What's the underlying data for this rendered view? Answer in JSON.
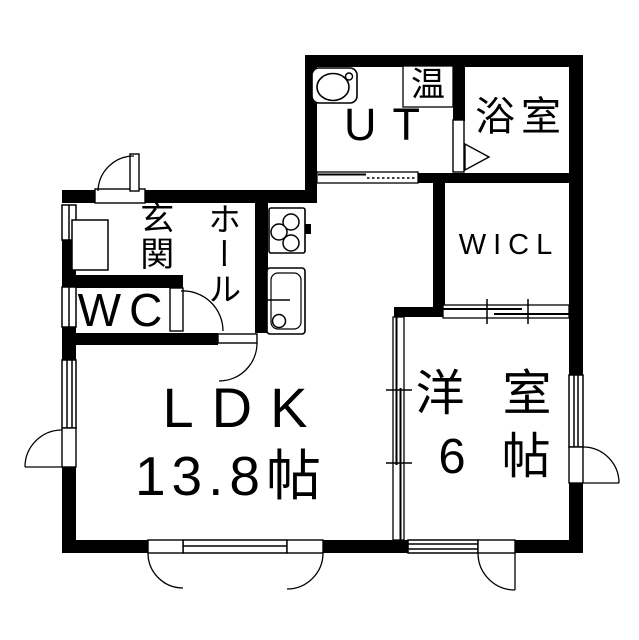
{
  "meta": {
    "type": "floor-plan",
    "background_color": "#ffffff",
    "wall_color": "#000000"
  },
  "rooms": {
    "bath": {
      "label": "浴室"
    },
    "ut": {
      "label": "UT"
    },
    "water_heater": {
      "label": "温"
    },
    "wicl": {
      "label": "WICL"
    },
    "genkan": {
      "label": "玄関"
    },
    "hall": {
      "label": "ホール"
    },
    "wc": {
      "label": "WC"
    },
    "ldk": {
      "label": "LDK",
      "size": "13.8帖"
    },
    "western": {
      "label": "洋室",
      "size": "6帖"
    }
  },
  "icons": {
    "washbasin": "washbasin-icon",
    "stove": "stove-icon",
    "kitchen_sink": "kitchen-sink-icon",
    "shoe_cabinet": "shoe-cabinet-icon",
    "bath_door": "bath-door-triangle-icon"
  }
}
